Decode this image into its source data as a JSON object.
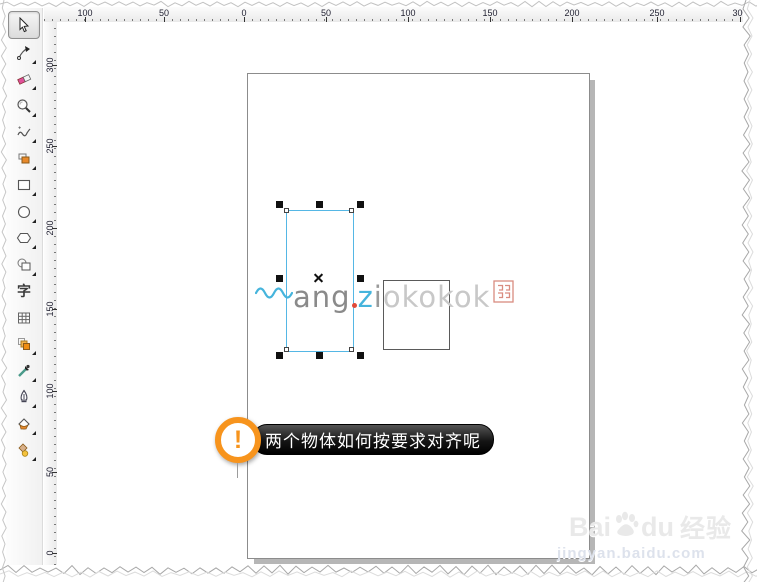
{
  "app": {
    "type": "vector-graphics-editor-canvas"
  },
  "toolbar": {
    "items": [
      {
        "name": "pick-tool",
        "active": true,
        "flyout": false
      },
      {
        "name": "shape-tool",
        "active": false,
        "flyout": true
      },
      {
        "name": "crop-eraser-tool",
        "active": false,
        "flyout": true
      },
      {
        "name": "zoom-tool",
        "active": false,
        "flyout": true
      },
      {
        "name": "freehand-tool",
        "active": false,
        "flyout": true
      },
      {
        "name": "smart-fill-tool",
        "active": false,
        "flyout": true
      },
      {
        "name": "rectangle-tool",
        "active": false,
        "flyout": true
      },
      {
        "name": "ellipse-tool",
        "active": false,
        "flyout": true
      },
      {
        "name": "polygon-tool",
        "active": false,
        "flyout": true
      },
      {
        "name": "basic-shapes-tool",
        "active": false,
        "flyout": true
      },
      {
        "name": "text-tool",
        "active": false,
        "flyout": false
      },
      {
        "name": "table-tool",
        "active": false,
        "flyout": false
      },
      {
        "name": "contour-tool",
        "active": false,
        "flyout": true
      },
      {
        "name": "eyedropper-tool",
        "active": false,
        "flyout": true
      },
      {
        "name": "outline-pen-tool",
        "active": false,
        "flyout": true
      },
      {
        "name": "fill-tool",
        "active": false,
        "flyout": true
      },
      {
        "name": "interactive-fill-tool",
        "active": false,
        "flyout": true
      }
    ],
    "text_tool_glyph": "字"
  },
  "rulers": {
    "horizontal": {
      "ticks": [
        {
          "label": "100",
          "pos": 41
        },
        {
          "label": "50",
          "pos": 120
        },
        {
          "label": "0",
          "pos": 200
        },
        {
          "label": "50",
          "pos": 282
        },
        {
          "label": "100",
          "pos": 364
        },
        {
          "label": "150",
          "pos": 446
        },
        {
          "label": "200",
          "pos": 528
        },
        {
          "label": "250",
          "pos": 613
        },
        {
          "label": "300",
          "pos": 696
        }
      ]
    },
    "vertical": {
      "ticks": [
        {
          "label": "300",
          "pos": 43
        },
        {
          "label": "250",
          "pos": 124
        },
        {
          "label": "200",
          "pos": 206
        },
        {
          "label": "150",
          "pos": 287
        },
        {
          "label": "100",
          "pos": 369
        },
        {
          "label": "50",
          "pos": 450
        },
        {
          "label": "0",
          "pos": 531
        }
      ]
    }
  },
  "watermark_logo": {
    "letters_gray": "ang",
    "letters_cyan": "z",
    "letters_gray2": "i",
    "letters_light": "okokok",
    "wave_color": "#45b4dc",
    "accent_color": "#e04a3a",
    "seal_color": "#d98c80"
  },
  "callout": {
    "icon_glyph": "!",
    "text": "两个物体如何按要求对齐呢",
    "accent_color": "#f7941d",
    "pill_color": "#000000"
  },
  "site_watermark": {
    "brand_latin_1": "Bai",
    "brand_latin_2": "du",
    "brand_cjk": "经验",
    "url": "jingyan.baidu.com"
  },
  "selection": {
    "handle_color": "#111111",
    "outline_color": "#55b7e5"
  }
}
